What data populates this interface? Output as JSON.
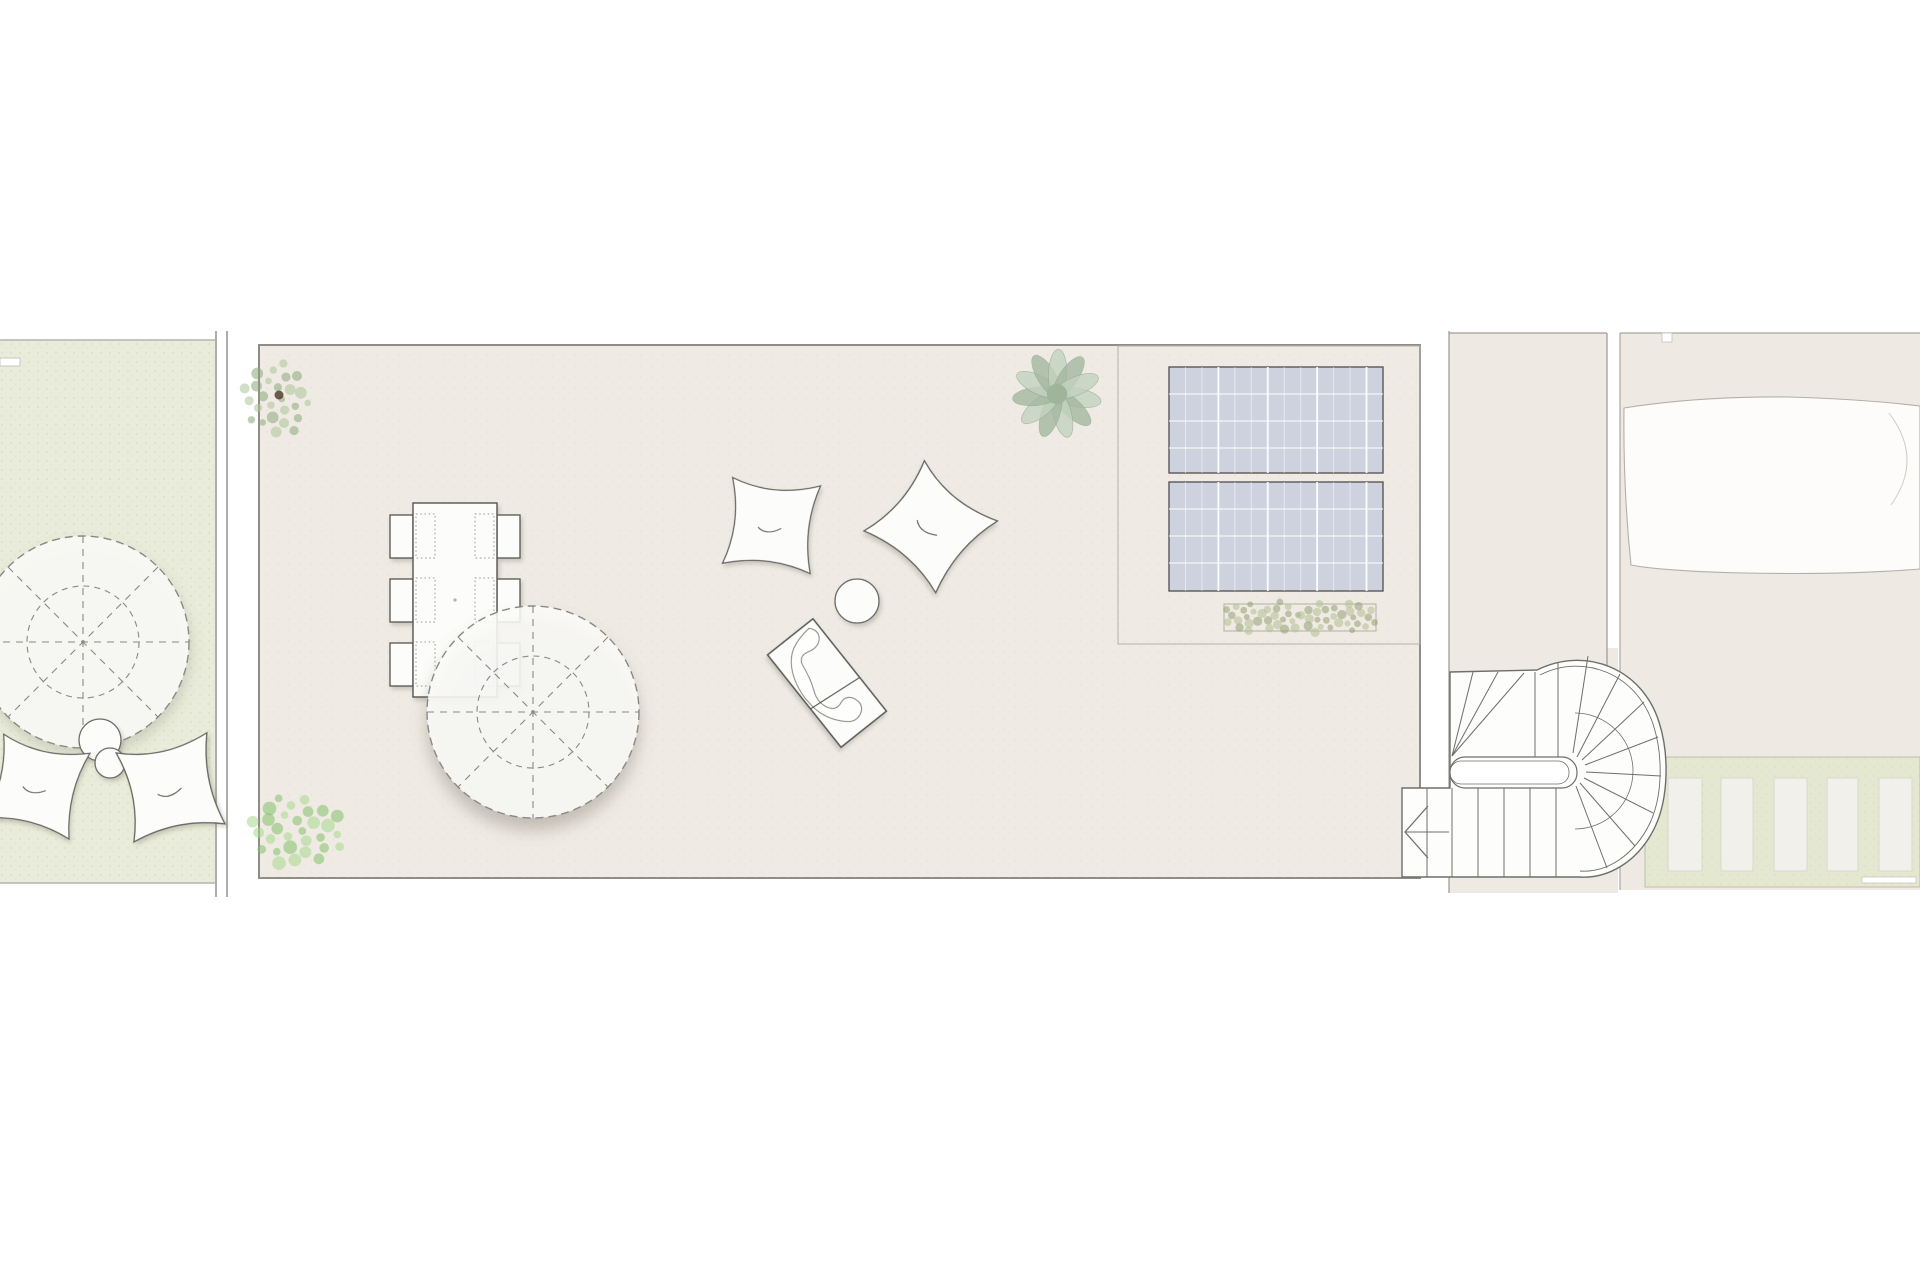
{
  "title": "roof-terrace-floor-plan",
  "palette": {
    "page_bg": "#ffffff",
    "terrace_fill": "#efebe4",
    "terrace_border": "#8f8c85",
    "garden_fill": "#e9ecda",
    "garden_border": "#b4b5a9",
    "lawn_fill": "#e4e8d1",
    "lawn_border": "#bcc0ab",
    "court_fill": "#eeeae3",
    "court_border": "#a29e96",
    "furniture_fill": "#fcfcfa",
    "furniture_stroke": "#55544f",
    "dash_stroke": "#8a8a84",
    "panel_fill": "#cdd2de",
    "panel_stroke": "#4e4e4e",
    "panel_grid": "#ffffff",
    "pool_fill": "#fdfcfa",
    "pool_stroke": "#b3b0a9",
    "slab_fill": "#f1f0ea",
    "slab_stroke": "#d9d8cf",
    "stair_fill": "#fdfdfc",
    "stair_stroke": "#6e6e6a",
    "plant_olive": [
      "#8aa878",
      "#a9c598"
    ],
    "plant_bright": [
      "#82c167",
      "#a8d88d"
    ],
    "plant_sage": [
      "#c3d3c0",
      "#a3b8a0"
    ],
    "plant_shrub": [
      "#94a173",
      "#b3bf92"
    ],
    "plant_core": "#53402f"
  },
  "regions": {
    "left_garden": {
      "rect": [
        0,
        340,
        215,
        543
      ],
      "wall_slot": [
        0,
        358,
        20,
        8
      ],
      "wall_lines": [
        [
          216,
          331,
          216,
          897
        ],
        [
          227,
          331,
          227,
          897
        ]
      ]
    },
    "main_terrace": {
      "rect": [
        259,
        345,
        1161,
        533
      ],
      "solar_zone": [
        1118,
        346,
        302,
        298
      ]
    },
    "stair_court": {
      "outline": "M 1449 333 H 1607 V 648 H 1618 V 893 H 1449 Z",
      "border_lines": [
        [
          1449,
          331,
          1449,
          893
        ],
        [
          1449,
          333,
          1607,
          333
        ],
        [
          1607,
          333,
          1607,
          668
        ]
      ]
    },
    "right_parcel": {
      "rect": [
        1620,
        333,
        300,
        557
      ],
      "border_lines": [
        [
          1620,
          333,
          1920,
          333
        ],
        [
          1620,
          333,
          1620,
          890
        ]
      ],
      "notch": [
        1662,
        333,
        10,
        9
      ],
      "lawn_band": [
        1645,
        757,
        275,
        130
      ],
      "plank": [
        1862,
        877,
        54,
        6
      ]
    }
  },
  "objects": {
    "parasols": [
      {
        "cx": 533,
        "cy": 712,
        "r_outer": 106,
        "r_inner": 56,
        "shadow": "big"
      },
      {
        "cx": 83,
        "cy": 642,
        "r_outer": 106,
        "r_inner": 56,
        "shadow": "med"
      }
    ],
    "dining_table": {
      "rect": [
        413,
        503,
        84,
        194
      ],
      "center_dot": [
        455,
        600
      ]
    },
    "chairs": [
      [
        390,
        515
      ],
      [
        390,
        579
      ],
      [
        390,
        643
      ],
      [
        497,
        515
      ],
      [
        497,
        579
      ],
      [
        497,
        643
      ]
    ],
    "chair_size": [
      23,
      43
    ],
    "placemats": [
      [
        416,
        514
      ],
      [
        416,
        578
      ],
      [
        416,
        642
      ],
      [
        475,
        514
      ],
      [
        475,
        578
      ],
      [
        475,
        642
      ]
    ],
    "placemat_size": [
      19,
      44
    ],
    "pillow_path": "M -46 -43 Q -2 -28 45 -47 Q 32 -2 47 44 Q 2 30 -44 46 Q -30 2 -46 -43 Z",
    "pillow_crease": "M -13 4 Q -3 12 11 2",
    "pillows": [
      {
        "cx": 771,
        "cy": 525,
        "scale": 0.97,
        "rot": 8
      },
      {
        "cx": 930,
        "cy": 526,
        "scale": 1.04,
        "rot": 42
      },
      {
        "cx": 36,
        "cy": 786,
        "scale": 0.97,
        "rot": 15
      },
      {
        "cx": 170,
        "cy": 788,
        "scale": 1.02,
        "rot": -10
      }
    ],
    "side_tables": [
      {
        "cx": 857,
        "cy": 601,
        "r": 22
      },
      {
        "cx": 100,
        "cy": 740,
        "r": 21
      },
      {
        "cx": 110,
        "cy": 763,
        "r": 15
      }
    ],
    "chaise": {
      "cx": 827,
      "cy": 683,
      "len": 118,
      "wid": 58,
      "rot": 51.5,
      "cross_line": [
        16,
        -29,
        10,
        29
      ],
      "squiggle": "M -54 -20 Q -46 -27 -39 -21 Q -33 -15 -36 -5 Q -39 6 -29 8 Q -14 10 -2 15 Q 9 20 19 15 Q 28 10 24 1 Q 21 -8 30 -12 Q 40 -16 45 -7 Q 49 2 42 9 Q 31 21 15 25 Q -5 29 -23 23 Q -41 17 -48 4 Q -53 -6 -54 -20 Z"
    },
    "solar_panels": [
      [
        1169,
        367,
        214,
        106
      ],
      [
        1169,
        482,
        214,
        109
      ]
    ],
    "panel_grid": {
      "v_lines": 12,
      "h_step": 27,
      "major_every": 3
    },
    "planter": {
      "rect": [
        1224,
        604,
        152,
        27
      ],
      "shrub_centers": [
        [
          1243,
          617
        ],
        [
          1281,
          617
        ],
        [
          1319,
          617
        ],
        [
          1357,
          617
        ]
      ],
      "shrub_r": 20,
      "dots": 14,
      "dot_r": 5
    },
    "plants": [
      {
        "kind": "cluster",
        "cx": 277,
        "cy": 399,
        "rx": 34,
        "ry": 38,
        "n": 26,
        "dot": 6,
        "colors": "plant_olive",
        "core": true
      },
      {
        "kind": "cluster",
        "cx": 296,
        "cy": 831,
        "rx": 49,
        "ry": 36,
        "n": 30,
        "dot": 7,
        "colors": "plant_bright",
        "core": false
      },
      {
        "kind": "rosette",
        "cx": 1057,
        "cy": 394,
        "r": 46,
        "petals": 11,
        "colors": "plant_sage",
        "core": true
      }
    ],
    "pool": {
      "path": "M 1624 408 Q 1700 396 1788 397 Q 1862 399 1920 406 L 1920 569 Q 1845 575 1745 573 Q 1662 571 1631 565 Q 1623 488 1624 408 Z",
      "inner_arc": "M 1889 413 Q 1924 459 1891 505"
    },
    "slabs": [
      [
        1668,
        778,
        34,
        93
      ],
      [
        1721,
        778,
        32,
        93
      ],
      [
        1774,
        778,
        33,
        93
      ],
      [
        1827,
        778,
        31,
        93
      ],
      [
        1879,
        778,
        33,
        93
      ]
    ],
    "stair": {
      "footprint": "M 1450 672 L 1537 670 C 1585 646 1642 668 1659 722 C 1669 753 1669 797 1655 827 C 1638 862 1608 879 1579 877 L 1402 877 L 1402 788 L 1450 788 Z",
      "outer_rail": "M 1540 675 C 1583 653 1636 673 1653 724 C 1663 754 1663 795 1650 823 C 1634 856 1606 873 1580 871",
      "slot_outer": [
        1450,
        757,
        127,
        31,
        15
      ],
      "slot_inner": [
        1450,
        761,
        119,
        23,
        11
      ],
      "winders_upper": [
        [
          1452,
          756,
          1473,
          672
        ],
        [
          1452,
          756,
          1498,
          672
        ],
        [
          1452,
          756,
          1524,
          673
        ]
      ],
      "edge_lines": [
        [
          1535,
          672,
          1535,
          757
        ],
        [
          1558,
          662,
          1558,
          757
        ]
      ],
      "radials": [
        [
          1573,
          753,
          1588,
          656
        ],
        [
          1577,
          757,
          1620,
          674
        ],
        [
          1582,
          760,
          1644,
          702
        ],
        [
          1585,
          765,
          1658,
          737
        ],
        [
          1586,
          772,
          1661,
          776
        ],
        [
          1584,
          778,
          1653,
          813
        ],
        [
          1580,
          783,
          1635,
          846
        ],
        [
          1576,
          786,
          1607,
          868
        ]
      ],
      "inner_arc": "M 1575 713 A 58 58 0 0 1 1575 829",
      "treads_lower_x": [
        1427,
        1452,
        1478,
        1504,
        1530,
        1556
      ],
      "treads_lower_y": [
        788,
        877
      ],
      "arrow_chevron": [
        [
          1428,
          806
        ],
        [
          1405,
          832
        ],
        [
          1428,
          858
        ]
      ],
      "arrow_shaft": [
        1405,
        832,
        1449,
        832
      ]
    }
  }
}
